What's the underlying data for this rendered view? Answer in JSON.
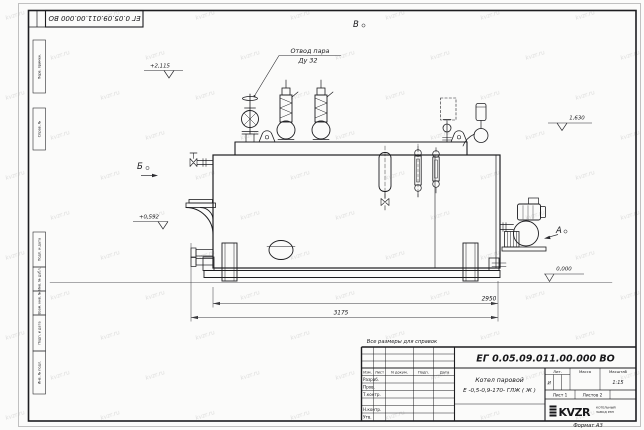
{
  "sheet": {
    "corner_stamp": "ЕГ 0.05.09.011.00.000  ВО",
    "note": "Все размеры для справок",
    "format_label": "Формат А3",
    "watermark": "kvzr.ru"
  },
  "margin_labels": [
    "Перв. примен.",
    "Справ. №",
    "Подп. и дата",
    "Инв. № дубл.",
    "Взам. инв. №",
    "Подп. и дата",
    "Инв. № подл."
  ],
  "drawing": {
    "callout": {
      "line1": "Отвод пара",
      "line2": "Ду 32"
    },
    "views": {
      "b": "Б",
      "v": "В",
      "a": "А"
    },
    "elevations": {
      "top": "+2,115",
      "right": "1,630",
      "left": "+0,592",
      "zero": "0,000"
    },
    "dims": {
      "inner": "2950",
      "overall": "3175"
    }
  },
  "title_block": {
    "doc_number": "ЕГ 0.05.09.011.00.000  ВО",
    "name_line1": "Котел паровой",
    "name_line2": "Е -0,5-0,9-170- ГЛЖ ( Ж )",
    "cols": [
      "Изм.",
      "Лист",
      "N докум.",
      "Подп.",
      "Дата"
    ],
    "rows": [
      "Разраб.",
      "Пров.",
      "Т.контр.",
      "Н.контр.",
      "Утв."
    ],
    "lit_label": "Лит.",
    "mass_label": "Масса",
    "scale_label": "Масштаб",
    "lit_value": "И",
    "scale_value": "1:15",
    "sheet_info": "Лист 1",
    "sheets_info": "Листов 2",
    "logo": "KVZR",
    "logo_caption1": "КОТЕЛЬНЫЙ",
    "logo_caption2": "ЗАВОД РЭП"
  }
}
